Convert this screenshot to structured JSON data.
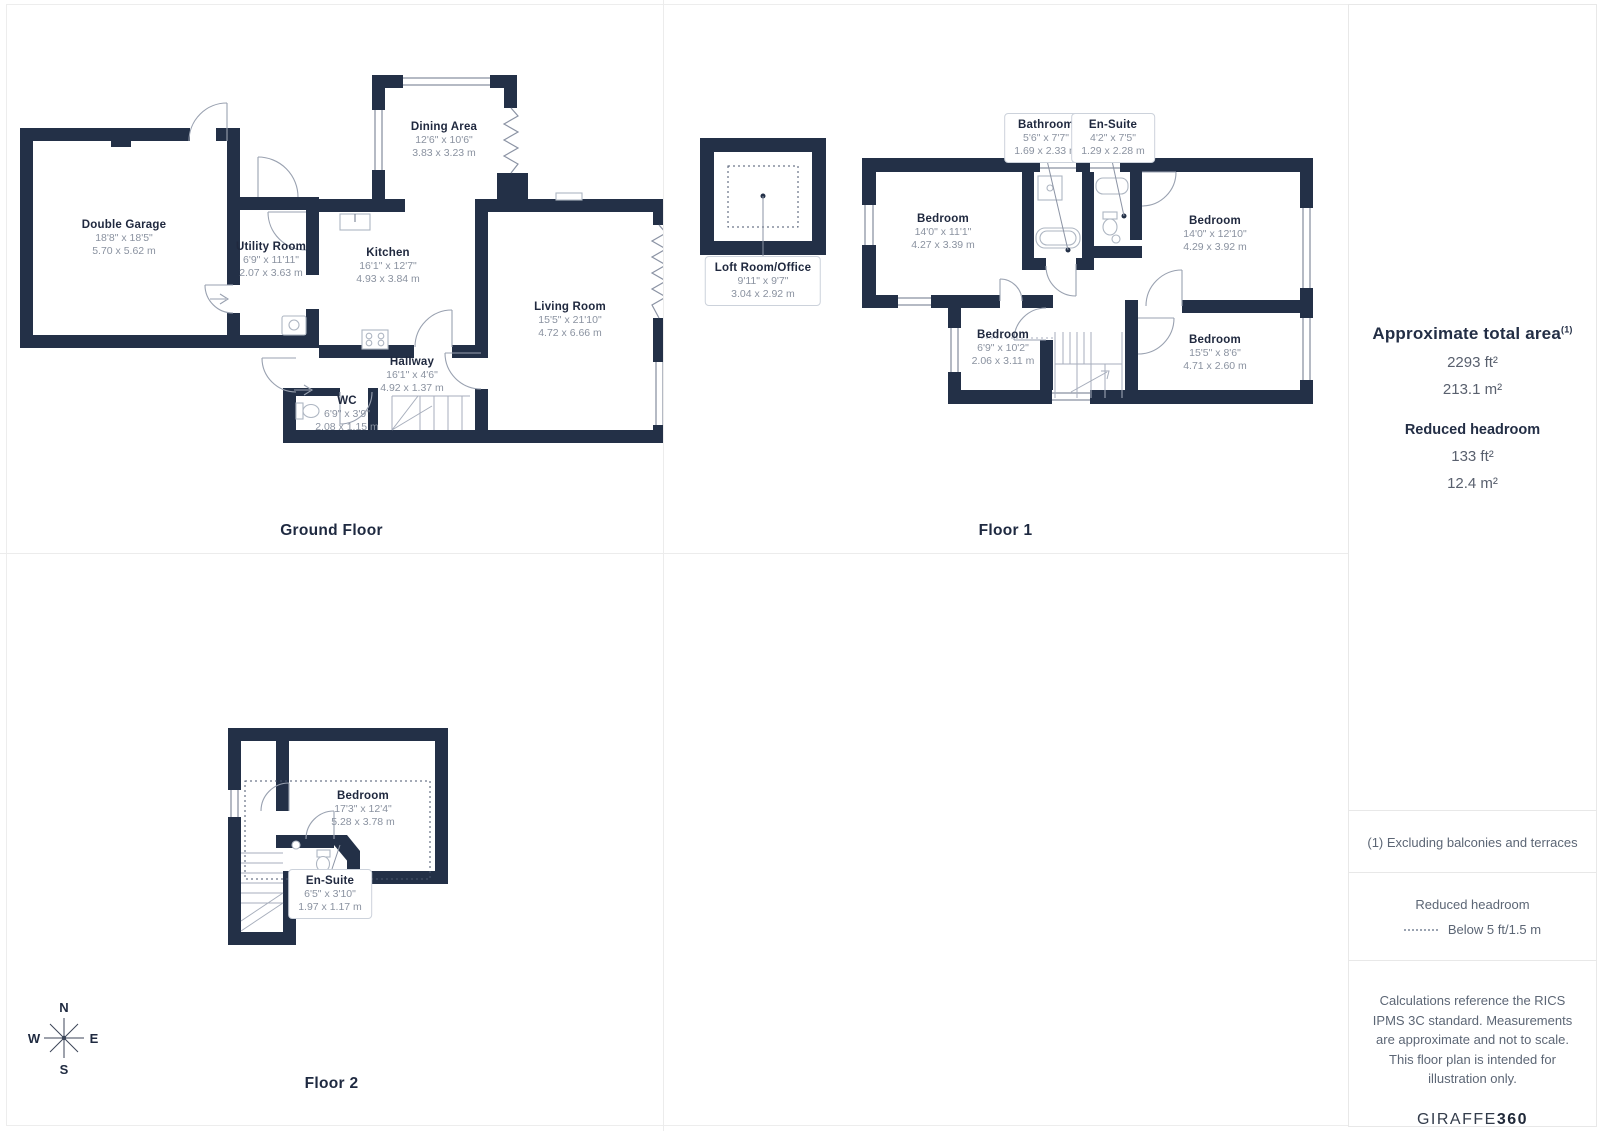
{
  "floors": [
    {
      "title": "Ground Floor",
      "rooms": [
        {
          "name": "Double Garage",
          "ft": "18'8\" x 18'5\"",
          "m": "5.70 x 5.62 m"
        },
        {
          "name": "Utility Room",
          "ft": "6'9\" x 11'11\"",
          "m": "2.07 x 3.63 m"
        },
        {
          "name": "Dining Area",
          "ft": "12'6\" x 10'6\"",
          "m": "3.83 x 3.23 m"
        },
        {
          "name": "Kitchen",
          "ft": "16'1\" x 12'7\"",
          "m": "4.93 x 3.84 m"
        },
        {
          "name": "Living Room",
          "ft": "15'5\" x 21'10\"",
          "m": "4.72 x 6.66 m"
        },
        {
          "name": "Hallway",
          "ft": "16'1\" x 4'6\"",
          "m": "4.92 x 1.37 m"
        },
        {
          "name": "WC",
          "ft": "6'9\" x 3'9\"",
          "m": "2.08 x 1.15 m"
        }
      ]
    },
    {
      "title": "Floor 1",
      "rooms": [
        {
          "name": "Loft Room/Office",
          "ft": "9'11\" x 9'7\"",
          "m": "3.04 x 2.92 m"
        },
        {
          "name": "Bathroom",
          "ft": "5'6\" x 7'7\"",
          "m": "1.69 x 2.33 m"
        },
        {
          "name": "En-Suite",
          "ft": "4'2\" x 7'5\"",
          "m": "1.29 x 2.28 m"
        },
        {
          "name": "Bedroom",
          "ft": "14'0\" x 11'1\"",
          "m": "4.27 x 3.39 m"
        },
        {
          "name": "Bedroom",
          "ft": "14'0\" x 12'10\"",
          "m": "4.29 x 3.92 m"
        },
        {
          "name": "Bedroom",
          "ft": "6'9\" x 10'2\"",
          "m": "2.06 x 3.11 m"
        },
        {
          "name": "Bedroom",
          "ft": "15'5\" x 8'6\"",
          "m": "4.71 x 2.60 m"
        }
      ]
    },
    {
      "title": "Floor 2",
      "rooms": [
        {
          "name": "Bedroom",
          "ft": "17'3\" x 12'4\"",
          "m": "5.28 x 3.78 m"
        },
        {
          "name": "En-Suite",
          "ft": "6'5\" x 3'10\"",
          "m": "1.97 x 1.17 m"
        }
      ]
    }
  ],
  "compass": {
    "n": "N",
    "e": "E",
    "s": "S",
    "w": "W"
  },
  "panel": {
    "title": "Approximate total area",
    "title_sup": "(1)",
    "total_ft": "2293 ft²",
    "total_m": "213.1 m²",
    "reduced_title": "Reduced headroom",
    "reduced_ft": "133 ft²",
    "reduced_m": "12.4 m²",
    "footnote": "(1) Excluding balconies and terraces",
    "legend_title": "Reduced headroom",
    "legend_label": "Below 5 ft/1.5 m",
    "disclaimer": "Calculations reference the RICS IPMS 3C standard. Measurements are approximate and not to scale. This floor plan is intended for illustration only.",
    "brand_name": "GIRAFFE",
    "brand_number": "360"
  },
  "colors": {
    "wall": "#233047",
    "accent": "#8b93a4",
    "text": "#20293f"
  }
}
